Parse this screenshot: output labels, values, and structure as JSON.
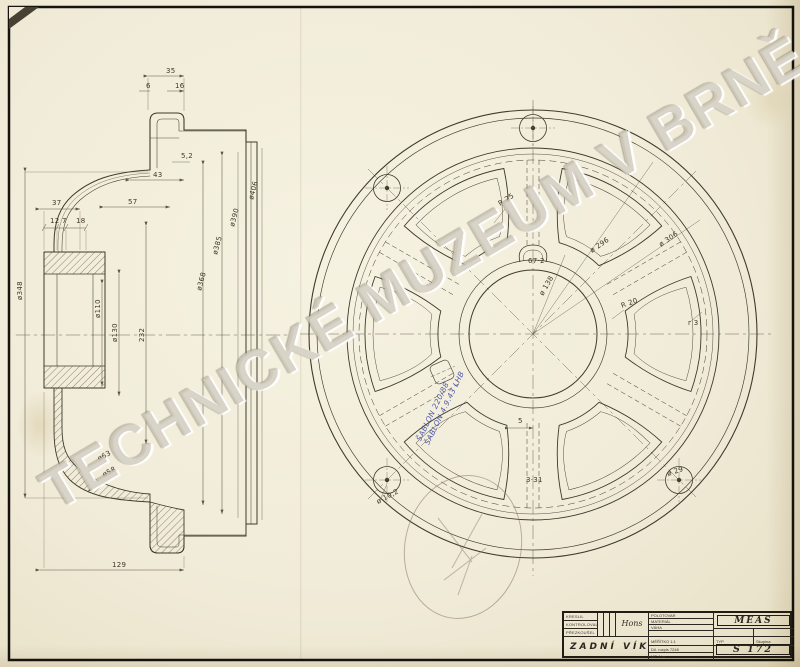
{
  "document": {
    "watermark": "TECHNICKÉ MUZEUM V BRNĚ",
    "part_title": "ZADNÍ VÍKO",
    "drawing_number": "S 172",
    "company": "MEAS"
  },
  "colors": {
    "paper": "#f1ecd9",
    "ink": "#3c372a",
    "stamp_blue": "#3f4aa6"
  },
  "title_block": {
    "company": "MEAS",
    "drawing_number": "S 172",
    "part_title": "ZADNÍ VÍKO",
    "row_labels": [
      "KRESLIL",
      "KONTROLOVAL",
      "PŘEZKOUŠEL"
    ],
    "signature": "Hons",
    "mid_rows": [
      "POLOTOVAR",
      "MATERIÁL",
      "VÁHA"
    ],
    "scale_label": "MĚŘÍTKO 1:1",
    "typ_label": "TYP",
    "skupina_label": "Skupina",
    "rozpis_label": "Díl. rozpis 7246",
    "mt_label": "MT 4 ks"
  },
  "annotations": {
    "blue_stamp_line1": "ŠABLON 220/88",
    "blue_stamp_line2": "ŠABLON 4.9.43 LHB"
  },
  "section_view": {
    "labels": [
      {
        "text": "35",
        "x": 166,
        "y": 73,
        "r": 0
      },
      {
        "text": "6",
        "x": 146,
        "y": 88,
        "r": 0
      },
      {
        "text": "16",
        "x": 175,
        "y": 88,
        "r": 0
      },
      {
        "text": "5,2",
        "x": 181,
        "y": 158,
        "r": 0
      },
      {
        "text": "43",
        "x": 153,
        "y": 177,
        "r": 0
      },
      {
        "text": "57",
        "x": 128,
        "y": 204,
        "r": 0
      },
      {
        "text": "37",
        "x": 52,
        "y": 205,
        "r": 0
      },
      {
        "text": "12",
        "x": 50,
        "y": 223,
        "r": 0
      },
      {
        "text": "7",
        "x": 62,
        "y": 223,
        "r": 0
      },
      {
        "text": "18",
        "x": 76,
        "y": 223,
        "r": 0
      },
      {
        "text": "ø348",
        "x": 22,
        "y": 300,
        "r": -90
      },
      {
        "text": "ø110",
        "x": 100,
        "y": 318,
        "r": -90
      },
      {
        "text": "ø130",
        "x": 117,
        "y": 342,
        "r": -90
      },
      {
        "text": "232",
        "x": 144,
        "y": 342,
        "r": -90
      },
      {
        "text": "ø368",
        "x": 201,
        "y": 291,
        "r": -75
      },
      {
        "text": "ø385",
        "x": 217,
        "y": 255,
        "r": -75
      },
      {
        "text": "ø390",
        "x": 234,
        "y": 227,
        "r": -75
      },
      {
        "text": "ø406",
        "x": 253,
        "y": 200,
        "r": -75
      },
      {
        "text": "ø63",
        "x": 99,
        "y": 461,
        "r": -28
      },
      {
        "text": "ø58",
        "x": 104,
        "y": 477,
        "r": -28
      },
      {
        "text": "129",
        "x": 112,
        "y": 567,
        "r": 0
      }
    ]
  },
  "circular_view": {
    "labels": [
      {
        "text": "R 25",
        "x": 500,
        "y": 206,
        "r": -32
      },
      {
        "text": "ø 296",
        "x": 592,
        "y": 253,
        "r": -35
      },
      {
        "text": "ø 306",
        "x": 661,
        "y": 247,
        "r": -35
      },
      {
        "text": "R 20",
        "x": 622,
        "y": 308,
        "r": -20
      },
      {
        "text": "r 3",
        "x": 688,
        "y": 325,
        "r": 0
      },
      {
        "text": "67·2",
        "x": 528,
        "y": 263,
        "r": 0
      },
      {
        "text": "ø 138",
        "x": 543,
        "y": 296,
        "r": -60
      },
      {
        "text": "5",
        "x": 518,
        "y": 423,
        "r": 0
      },
      {
        "text": "3·31",
        "x": 526,
        "y": 482,
        "r": 0
      },
      {
        "text": "ø 10,2",
        "x": 378,
        "y": 504,
        "r": -28
      },
      {
        "text": "ø 29",
        "x": 668,
        "y": 476,
        "r": -18
      }
    ]
  }
}
